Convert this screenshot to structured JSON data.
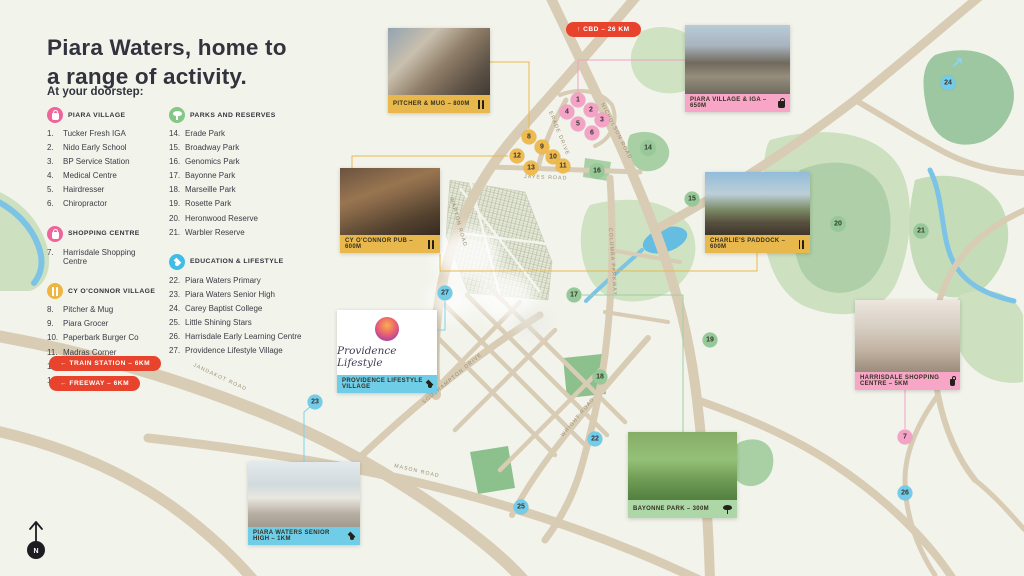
{
  "colors": {
    "accent_red": "#e8432d",
    "pink": "#f4a3c6",
    "yellow": "#edbb4f",
    "green": "#95c998",
    "blue": "#72cdea",
    "caption_pink": "#f7a6c7",
    "caption_yellow": "#e9b84d",
    "caption_green": "#aed7a8",
    "caption_blue": "#6fcde8",
    "ink": "#32333c",
    "road": "#d9ccb4",
    "background": "#f2f4ec"
  },
  "page": {
    "title_line1": "Piara Waters, home to",
    "title_line2": "a range of activity.",
    "subtitle": "At your doorstep:"
  },
  "badges": {
    "cbd": "↑ CBD – 26 KM",
    "train": "← TRAIN STATION – 6KM",
    "freeway": "← FREEWAY – 6KM"
  },
  "legend": {
    "columns": [
      {
        "sections": [
          {
            "title": "PIARA VILLAGE",
            "icon": "bag",
            "color": "#f0649c",
            "items": [
              {
                "num": "1.",
                "label": "Tucker Fresh IGA"
              },
              {
                "num": "2.",
                "label": "Nido Early School"
              },
              {
                "num": "3.",
                "label": "BP Service Station"
              },
              {
                "num": "4.",
                "label": "Medical Centre"
              },
              {
                "num": "5.",
                "label": "Hairdresser"
              },
              {
                "num": "6.",
                "label": "Chiropractor"
              }
            ]
          },
          {
            "title": "SHOPPING CENTRE",
            "icon": "bag",
            "color": "#f0649c",
            "items": [
              {
                "num": "7.",
                "label": "Harrisdale Shopping Centre"
              }
            ]
          },
          {
            "title": "CY O'CONNOR VILLAGE",
            "icon": "cutlery",
            "color": "#eeb545",
            "items": [
              {
                "num": "8.",
                "label": "Pitcher & Mug"
              },
              {
                "num": "9.",
                "label": "Piara Grocer"
              },
              {
                "num": "10.",
                "label": "Paperbark Burger Co"
              },
              {
                "num": "11.",
                "label": "Madras Corner"
              },
              {
                "num": "12.",
                "label": "CY O'Connor Pub"
              },
              {
                "num": "13.",
                "label": "Charlie's Paddock"
              }
            ]
          }
        ]
      },
      {
        "sections": [
          {
            "title": "PARKS AND RESERVES",
            "icon": "tree",
            "color": "#84c787",
            "items": [
              {
                "num": "14.",
                "label": "Erade Park"
              },
              {
                "num": "15.",
                "label": "Broadway Park"
              },
              {
                "num": "16.",
                "label": "Genomics Park"
              },
              {
                "num": "17.",
                "label": "Bayonne Park"
              },
              {
                "num": "18.",
                "label": "Marseille Park"
              },
              {
                "num": "19.",
                "label": "Rosette Park"
              },
              {
                "num": "20.",
                "label": "Heronwood Reserve"
              },
              {
                "num": "21.",
                "label": "Warbler Reserve"
              }
            ]
          },
          {
            "title": "EDUCATION & LIFESTYLE",
            "icon": "gradcap",
            "color": "#3fbde4",
            "items": [
              {
                "num": "22.",
                "label": "Piara Waters Primary"
              },
              {
                "num": "23.",
                "label": "Piara Waters Senior High"
              },
              {
                "num": "24.",
                "label": "Carey Baptist College"
              },
              {
                "num": "25.",
                "label": "Little Shining Stars"
              },
              {
                "num": "26.",
                "label": "Harrisdale Early Learning Centre"
              },
              {
                "num": "27.",
                "label": "Providence Lifestyle Village"
              }
            ]
          }
        ]
      }
    ]
  },
  "map": {
    "north_label": "N",
    "arrow_ne": "↗",
    "road_labels": [
      {
        "text": "NICHOLSON ROAD",
        "x": 601,
        "y": 104,
        "rot": 63
      },
      {
        "text": "ERADE DRIVE",
        "x": 549,
        "y": 112,
        "rot": 68
      },
      {
        "text": "JAYES ROAD",
        "x": 524,
        "y": 178,
        "rot": 2
      },
      {
        "text": "WARTON ROAD",
        "x": 450,
        "y": 198,
        "rot": 74
      },
      {
        "text": "COLUMBA PARKWAY",
        "x": 609,
        "y": 228,
        "rot": 86
      },
      {
        "text": "SOUTHAMPTON DRIVE",
        "x": 424,
        "y": 404,
        "rot": -40
      },
      {
        "text": "JANDAKOT ROAD",
        "x": 193,
        "y": 366,
        "rot": 25
      },
      {
        "text": "MASON ROAD",
        "x": 394,
        "y": 467,
        "rot": 13
      },
      {
        "text": "WRIGHT ROAD",
        "x": 563,
        "y": 437,
        "rot": -50
      }
    ],
    "connectors": [
      {
        "points": "490,62 529,62 529,129",
        "color": "#e9b84d"
      },
      {
        "points": "685,60 578,60 578,92",
        "color": "#f2a0c4"
      },
      {
        "points": "352,168 352,156 508,156",
        "color": "#e9b84d"
      },
      {
        "points": "757,253 757,271 440,271 440,254",
        "color": "#e9b84d"
      },
      {
        "points": "905,390 905,429",
        "color": "#f2a0c4"
      },
      {
        "points": "683,432 683,295 582,295",
        "color": "#9ed0a0"
      },
      {
        "points": "437,330 445,330 445,301",
        "color": "#7fd2ea"
      },
      {
        "points": "304,462 304,412 311,406",
        "color": "#7fd2ea"
      }
    ],
    "markers": [
      {
        "name": "marker-1",
        "num": "1",
        "x": 578,
        "y": 100,
        "color": "#f4a3c6"
      },
      {
        "name": "marker-2",
        "num": "2",
        "x": 591,
        "y": 110,
        "color": "#f4a3c6"
      },
      {
        "name": "marker-3",
        "num": "3",
        "x": 602,
        "y": 120,
        "color": "#f4a3c6"
      },
      {
        "name": "marker-4",
        "num": "4",
        "x": 567,
        "y": 112,
        "color": "#f4a3c6"
      },
      {
        "name": "marker-5",
        "num": "5",
        "x": 578,
        "y": 124,
        "color": "#f4a3c6"
      },
      {
        "name": "marker-6",
        "num": "6",
        "x": 592,
        "y": 133,
        "color": "#f4a3c6"
      },
      {
        "name": "marker-7",
        "num": "7",
        "x": 905,
        "y": 437,
        "color": "#f4a3c6"
      },
      {
        "name": "marker-8",
        "num": "8",
        "x": 529,
        "y": 137,
        "color": "#edbb4f"
      },
      {
        "name": "marker-9",
        "num": "9",
        "x": 542,
        "y": 147,
        "color": "#edbb4f"
      },
      {
        "name": "marker-10",
        "num": "10",
        "x": 553,
        "y": 157,
        "color": "#edbb4f"
      },
      {
        "name": "marker-11",
        "num": "11",
        "x": 563,
        "y": 166,
        "color": "#edbb4f"
      },
      {
        "name": "marker-12",
        "num": "12",
        "x": 517,
        "y": 156,
        "color": "#edbb4f"
      },
      {
        "name": "marker-13",
        "num": "13",
        "x": 531,
        "y": 168,
        "color": "#edbb4f"
      },
      {
        "name": "marker-14",
        "num": "14",
        "x": 648,
        "y": 148,
        "color": "#95c998"
      },
      {
        "name": "marker-15",
        "num": "15",
        "x": 692,
        "y": 199,
        "color": "#95c998"
      },
      {
        "name": "marker-16",
        "num": "16",
        "x": 597,
        "y": 171,
        "color": "#95c998"
      },
      {
        "name": "marker-17",
        "num": "17",
        "x": 574,
        "y": 295,
        "color": "#95c998"
      },
      {
        "name": "marker-18",
        "num": "18",
        "x": 600,
        "y": 377,
        "color": "#95c998"
      },
      {
        "name": "marker-19",
        "num": "19",
        "x": 710,
        "y": 340,
        "color": "#95c998"
      },
      {
        "name": "marker-20",
        "num": "20",
        "x": 838,
        "y": 224,
        "color": "#95c998"
      },
      {
        "name": "marker-21",
        "num": "21",
        "x": 921,
        "y": 231,
        "color": "#95c998"
      },
      {
        "name": "marker-22",
        "num": "22",
        "x": 595,
        "y": 439,
        "color": "#72cdea"
      },
      {
        "name": "marker-23",
        "num": "23",
        "x": 315,
        "y": 402,
        "color": "#72cdea"
      },
      {
        "name": "marker-24",
        "num": "24",
        "x": 948,
        "y": 83,
        "color": "#72cdea"
      },
      {
        "name": "marker-25",
        "num": "25",
        "x": 521,
        "y": 507,
        "color": "#72cdea"
      },
      {
        "name": "marker-26",
        "num": "26",
        "x": 905,
        "y": 493,
        "color": "#72cdea"
      },
      {
        "name": "marker-27",
        "num": "27",
        "x": 445,
        "y": 293,
        "color": "#72cdea"
      }
    ],
    "photos": [
      {
        "name": "photo-card-pitcher-mug",
        "caption": "PITCHER & MUG – 800M",
        "icon": "cutlery",
        "color": "#e9b84d",
        "cls": "ph-barista",
        "x": 388,
        "y": 28,
        "w": 102,
        "ph": 67
      },
      {
        "name": "photo-card-piara-village-iga",
        "caption": "PIARA VILLAGE & IGA – 650M",
        "icon": "bag",
        "color": "#f7a6c7",
        "cls": "ph-iga",
        "x": 685,
        "y": 25,
        "w": 105,
        "ph": 69
      },
      {
        "name": "photo-card-cy-oconnor-pub",
        "caption": "CY O'CONNOR PUB – 600M",
        "icon": "cutlery",
        "color": "#e9b84d",
        "cls": "ph-pub",
        "x": 340,
        "y": 168,
        "w": 100,
        "ph": 67
      },
      {
        "name": "photo-card-charlies-paddock",
        "caption": "CHARLIE'S PADDOCK – 600M",
        "icon": "cutlery",
        "color": "#e9b84d",
        "cls": "ph-charlies",
        "x": 705,
        "y": 172,
        "w": 105,
        "ph": 63
      },
      {
        "name": "photo-card-harrisdale-shopping",
        "caption": "HARRISDALE SHOPPING CENTRE – 5KM",
        "icon": "bag",
        "color": "#f7a6c7",
        "cls": "ph-harrisdale",
        "x": 855,
        "y": 300,
        "w": 105,
        "ph": 72
      },
      {
        "name": "photo-card-bayonne-park",
        "caption": "BAYONNE PARK – 300M",
        "icon": "tree",
        "color": "#aed7a8",
        "cls": "ph-bayonne",
        "x": 628,
        "y": 432,
        "w": 109,
        "ph": 68
      },
      {
        "name": "photo-card-senior-high",
        "caption": "PIARA WATERS SENIOR HIGH – 1KM",
        "icon": "gradcap",
        "color": "#6fcde8",
        "cls": "ph-seniorhigh",
        "x": 248,
        "y": 462,
        "w": 112,
        "ph": 65
      }
    ],
    "providence": {
      "caption": "PROVIDENCE LIFESTYLE VILLAGE",
      "logo_text": "Providence Lifestyle",
      "icon": "gradcap"
    }
  }
}
